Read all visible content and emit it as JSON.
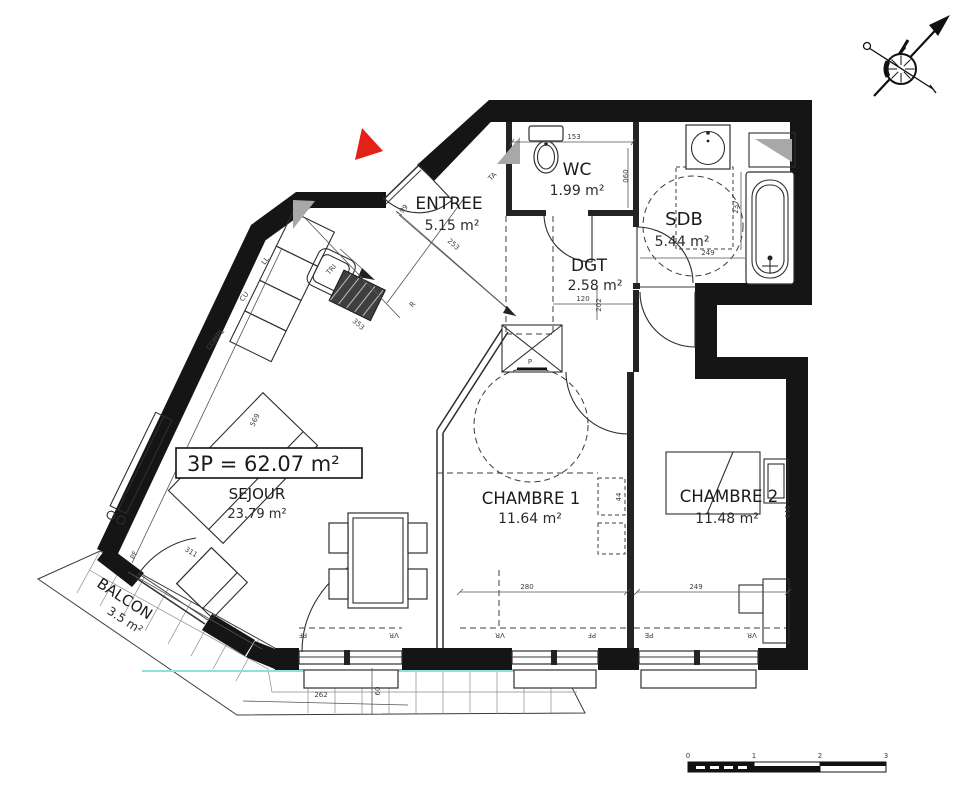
{
  "plan": {
    "title": "3P = 62.07 m²",
    "rooms": {
      "entree": {
        "name": "ENTREE",
        "area": "5.15 m²"
      },
      "wc": {
        "name": "WC",
        "area": "1.99 m²"
      },
      "sdb": {
        "name": "SDB",
        "area": "5.44 m²"
      },
      "dgt": {
        "name": "DGT",
        "area": "2.58 m²"
      },
      "sejour": {
        "name": "SEJOUR",
        "area": "23.79 m²"
      },
      "chambre1": {
        "name": "CHAMBRE 1",
        "area": "11.64 m²"
      },
      "chambre2": {
        "name": "CHAMBRE 2",
        "area": "11.48 m²"
      },
      "balcon": {
        "name": "BALCON",
        "area": "3.5 m²"
      }
    },
    "dims": {
      "d153": "153",
      "d060": "060",
      "d253": "253",
      "d199": "199",
      "d353": "353",
      "d249_sdb": "249",
      "d237": "237",
      "d120": "120",
      "d202": "202",
      "d569": "569",
      "d311": "311",
      "d280": "280",
      "d249_ch2": "249",
      "d262": "262",
      "d60": "60",
      "d44": "44",
      "d440": "440"
    },
    "ann": {
      "ta": "TA",
      "r": "R",
      "tri": "TRI",
      "ll": "LL",
      "cu": "CU",
      "compl": "COMPL",
      "p": "P",
      "pf": "PF",
      "vr": "VR",
      "pe": "PE"
    },
    "scale": {
      "n0": "0",
      "n1": "1",
      "n2": "2",
      "n3": "3"
    },
    "icons": {
      "compass": "compass-rose",
      "north_marker": "red-triangle"
    },
    "colors": {
      "wall": "#151515",
      "red": "#e32119",
      "cyan": "#8fe0dd",
      "gray": "#a8a8a8"
    }
  }
}
